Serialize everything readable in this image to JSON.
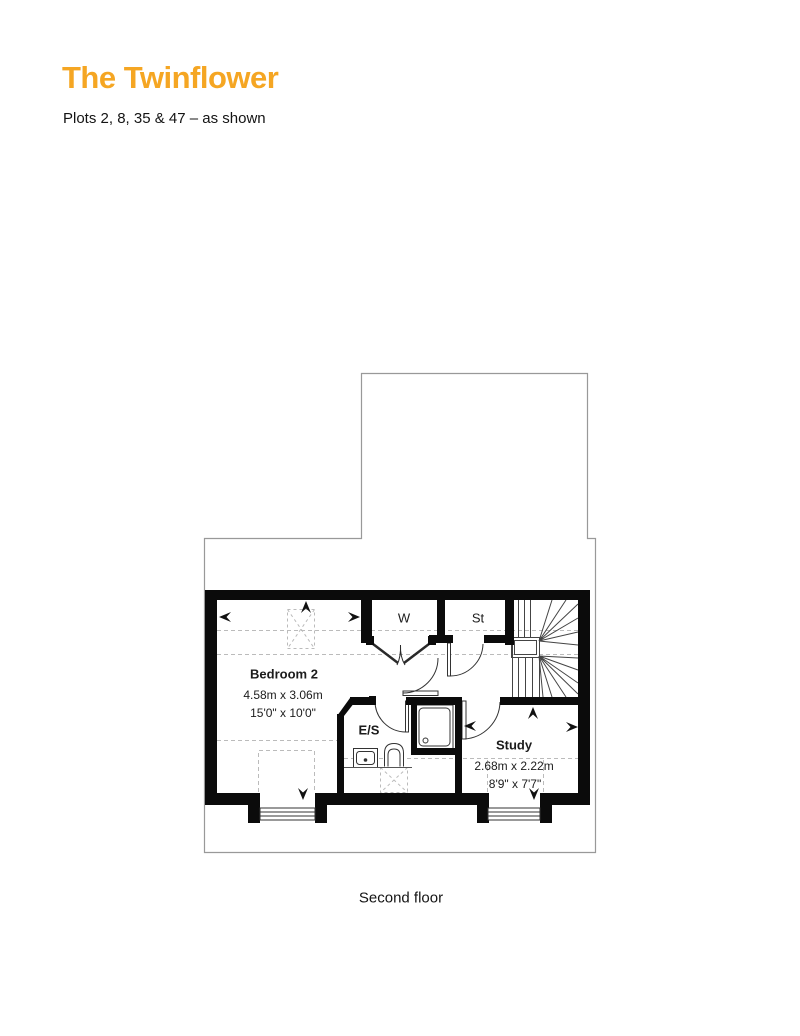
{
  "header": {
    "title": "The Twinflower",
    "subtitle": "Plots 2, 8, 35 & 47 – as shown"
  },
  "plan": {
    "caption": "Second floor",
    "rooms": {
      "bedroom2": {
        "name": "Bedroom 2",
        "metric": "4.58m x 3.06m",
        "imperial": "15'0\" x 10'0\""
      },
      "study": {
        "name": "Study",
        "metric": "2.68m x 2.22m",
        "imperial": "8'9\" x 7'7\""
      },
      "ensuite": {
        "label": "E/S"
      },
      "wardrobe": {
        "label": "W"
      },
      "store": {
        "label": "St"
      }
    },
    "icons": [
      "slope-arrow-up",
      "slope-arrow-left",
      "slope-arrow-right",
      "slope-arrow-down",
      "loft-hatch",
      "stairs",
      "shower",
      "toilet",
      "sink",
      "dormer-window"
    ],
    "colors": {
      "accent": "#F5A623",
      "wall": "#0B0B0B",
      "line": "#444444",
      "roof_outline": "#999999",
      "dashed_guide": "#BBBBBB"
    }
  }
}
